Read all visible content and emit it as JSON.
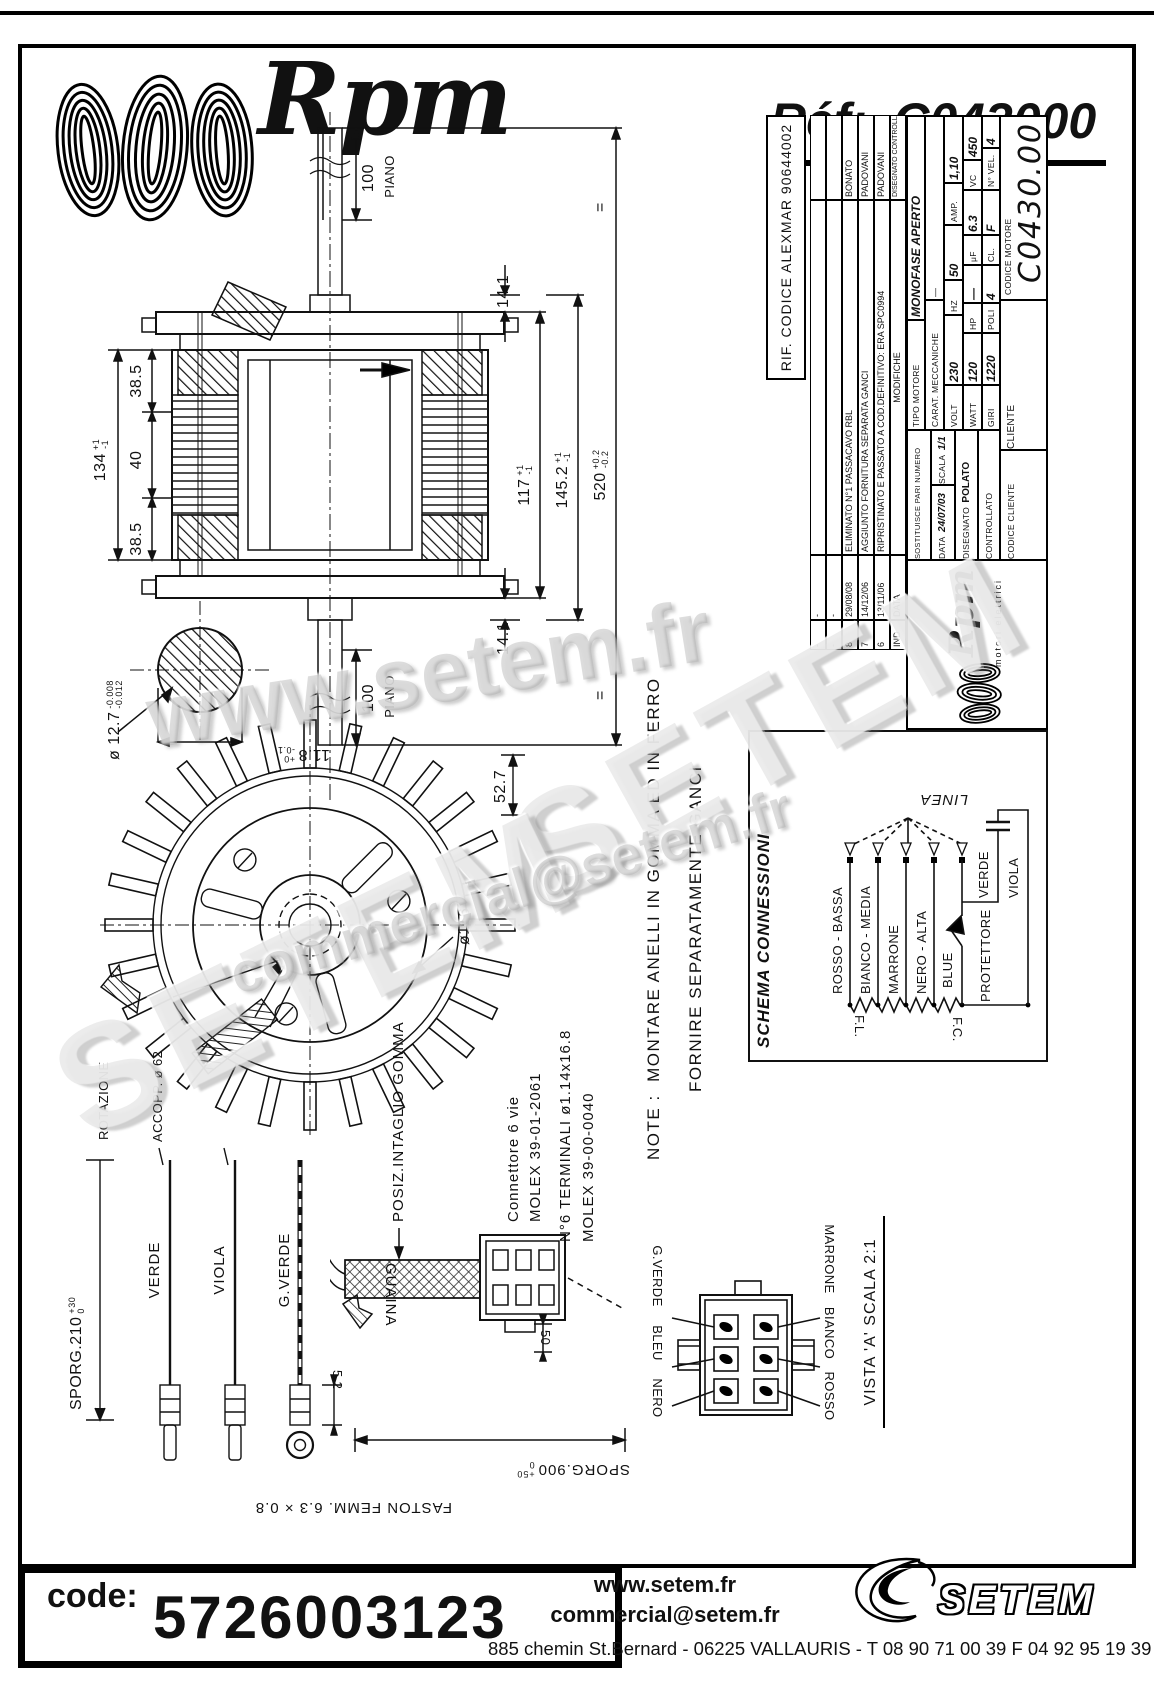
{
  "header": {
    "brand": "Rpm",
    "ref_label": "Réf:",
    "ref_value": "C043000"
  },
  "title_block": {
    "rif_codice": "RIF. CODICE ALEXMAR 90644002",
    "rev_rows": [
      {
        "ind": "-",
        "date": "-",
        "desc": "",
        "sign": ""
      },
      {
        "ind": "-",
        "date": "-",
        "desc": "",
        "sign": ""
      },
      {
        "ind": "8",
        "date": "29/08/08",
        "desc": "ELIMINATO N°1 PASSACAVO RBL",
        "sign": "BONATO"
      },
      {
        "ind": "7",
        "date": "14/12/06",
        "desc": "AGGIUNTO FORNITURA SEPARATA GANCI",
        "sign": "PADOVANI"
      },
      {
        "ind": "6",
        "date": "13/11/06",
        "desc": "RIPRISTINATO E PASSATO A COD.DEFINITIVO: ERA SPC0994",
        "sign": "PADOVANI"
      }
    ],
    "rev_header": {
      "ind": "IND",
      "date": "DATA",
      "desc": "MODIFICHE",
      "sign1": "DISEGNATO",
      "sign2": "CONTROLLATO"
    },
    "logo_brand": "Rpm",
    "logo_sub": "motori elettrici",
    "sostituisce": "SOSTITUISCE PARI NUMERO DEL",
    "sostituisce_value": "-",
    "data_label": "DATA",
    "data_value": "24/07/03",
    "scala_label": "SCALA",
    "scala_value": "1/1",
    "disegnato_label": "DISEGNATO",
    "disegnato_value": "POLATO",
    "controllato_label": "CONTROLLATO",
    "tipo_label": "TIPO MOTORE",
    "tipo_value": "MONOFASE APERTO",
    "carat_label": "CARAT. MECCANICHE",
    "carat_value": "—",
    "specs": {
      "volt_label": "VOLT",
      "volt": "230",
      "hz_label": "HZ",
      "hz": "50",
      "amp_label": "AMP.",
      "amp": "1,10",
      "watt_label": "WATT",
      "watt": "120",
      "hp_label": "HP",
      "hp": "—",
      "uf_label": "μF",
      "uf": "6.3",
      "vc_label": "VC",
      "vc": "450",
      "giri_label": "GIRI",
      "giri": "1220",
      "poli_label": "POLI",
      "poli": "4",
      "cl_label": "CL.",
      "cl": "F",
      "nvel_label": "N° VEL.",
      "nvel": "4"
    },
    "cliente_label": "CLIENTE",
    "codice_cliente_label": "CODICE CLIENTE",
    "codice_motore_label": "CODICE MOTORE",
    "codice_motore_value": "C0430.00"
  },
  "schema": {
    "title": "SCHEMA CONNESSIONI",
    "linea": "LINEA",
    "fl": "F.L.",
    "fc": "F.C.",
    "wire_labels": [
      "ROSSO - BASSA",
      "BIANCO - MEDIA",
      "MARRONE",
      "NERO - ALTA",
      "BLUE",
      "PROTETTORE",
      "VERDE",
      "VIOLA"
    ]
  },
  "drawing": {
    "dims": {
      "piano_top": "100",
      "piano_top_sub": "PIANO",
      "piano_bottom": "100",
      "piano_bottom_sub": "PIANO",
      "d141_a": "14.1",
      "d141_b": "14.1",
      "d134": "134",
      "d134_tol_plus": "+1",
      "d134_tol_minus": "-1",
      "d385_a": "38.5",
      "d40": "40",
      "d385_b": "38.5",
      "d117": "117",
      "d117_tol_plus": "+1",
      "d117_tol_minus": "-1",
      "d1452": "145.2",
      "d1452_tol_plus": "+1",
      "d1452_tol_minus": "-1",
      "d520": "520",
      "d520_tol_plus": "+0.2",
      "d520_tol_minus": "-0.2",
      "equal_a": "=",
      "equal_b": "=",
      "shaft_dia": "ø 12.7",
      "shaft_dia_tol_top": "-0.008",
      "shaft_dia_tol_bot": "-0.012",
      "d118": "11.8",
      "d118_tol_plus": "+0",
      "d118_tol_minus": "-0.1",
      "d527": "52.7",
      "accopp": "ACCOPP. ø 62",
      "rotazione": "ROTAZIONE",
      "fan_dia": "ø116"
    },
    "leads": {
      "sporg210": "SPORG.210",
      "sporg210_plus": "+30",
      "sporg210_minus": "0",
      "verde": "VERDE",
      "viola": "VIOLA",
      "gverde": "G.VERDE",
      "d52": "5.2",
      "faston": "FASTON FEMM. 6.3 × 0.8"
    },
    "cable": {
      "guaina": "GUAINA",
      "d50": "50",
      "sporg900": "SPORG.900",
      "sporg900_plus": "+50",
      "sporg900_minus": "0",
      "posiz": "POSIZ.INTAGLIO GOMMA",
      "conn_line1": "Connettore 6 vie",
      "conn_line2": "MOLEX 39-01-2061",
      "term_line1": "N°6 TERMINALI ø1.14x16.8",
      "term_line2": "MOLEX 39-00-0040"
    },
    "note": {
      "label": "NOTE :",
      "line1": "MONTARE ANELLI IN GOMMA ED IN FERRO",
      "line2": "FORNIRE SEPARATAMENTE GANCI"
    },
    "vista": {
      "title": "VISTA 'A'  SCALA 2:1",
      "top_labels": [
        "NERO",
        "BLEU",
        "G.VERDE"
      ],
      "bottom_labels": [
        "ROSSO",
        "BIANCO",
        "MARRONE"
      ]
    }
  },
  "watermarks": {
    "wm1": "www.setem.fr",
    "wm2": "SETEM",
    "wm3": "SETEM",
    "wm4": "commercial@setem.fr"
  },
  "footer": {
    "code_label": "code:",
    "code_value": "5726003123",
    "site": "www.setem.fr",
    "email": "commercial@setem.fr",
    "brand": "SETEM",
    "address": "885 chemin St.Bernard  -  06225 VALLAURIS  -  T 08 90 71 00 39   F 04 92 95 19 39"
  }
}
